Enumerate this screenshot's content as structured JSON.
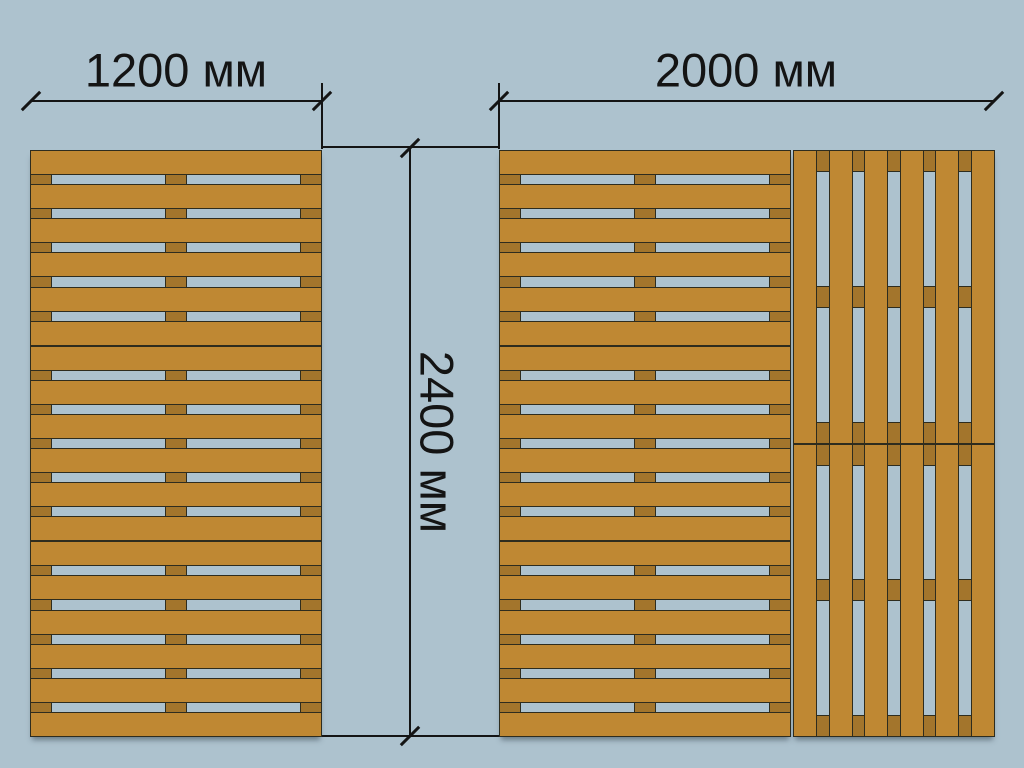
{
  "diagram": {
    "subject": "wooden-pallet-stacks-top-view-with-dimensions"
  },
  "labels": {
    "width_left": "1200 мм",
    "width_right": "2000 мм",
    "height": "2400 мм"
  },
  "colors": {
    "background": "#adc2ce",
    "board": "#bf8833",
    "stringer": "#a3752c",
    "outline": "#2e2c1e",
    "dimension": "#141414"
  },
  "pallets": [
    {
      "name": "left-stack",
      "board_orientation": "horizontal",
      "sections": 3,
      "boards_per_section": 6,
      "stringers_per_section": 3
    },
    {
      "name": "right-stack-horizontal",
      "board_orientation": "horizontal",
      "sections": 3,
      "boards_per_section": 6,
      "stringers_per_section": 3
    },
    {
      "name": "right-stack-vertical",
      "board_orientation": "vertical",
      "sections": 2,
      "boards_per_section": 6,
      "stringers_per_section": 3
    }
  ]
}
